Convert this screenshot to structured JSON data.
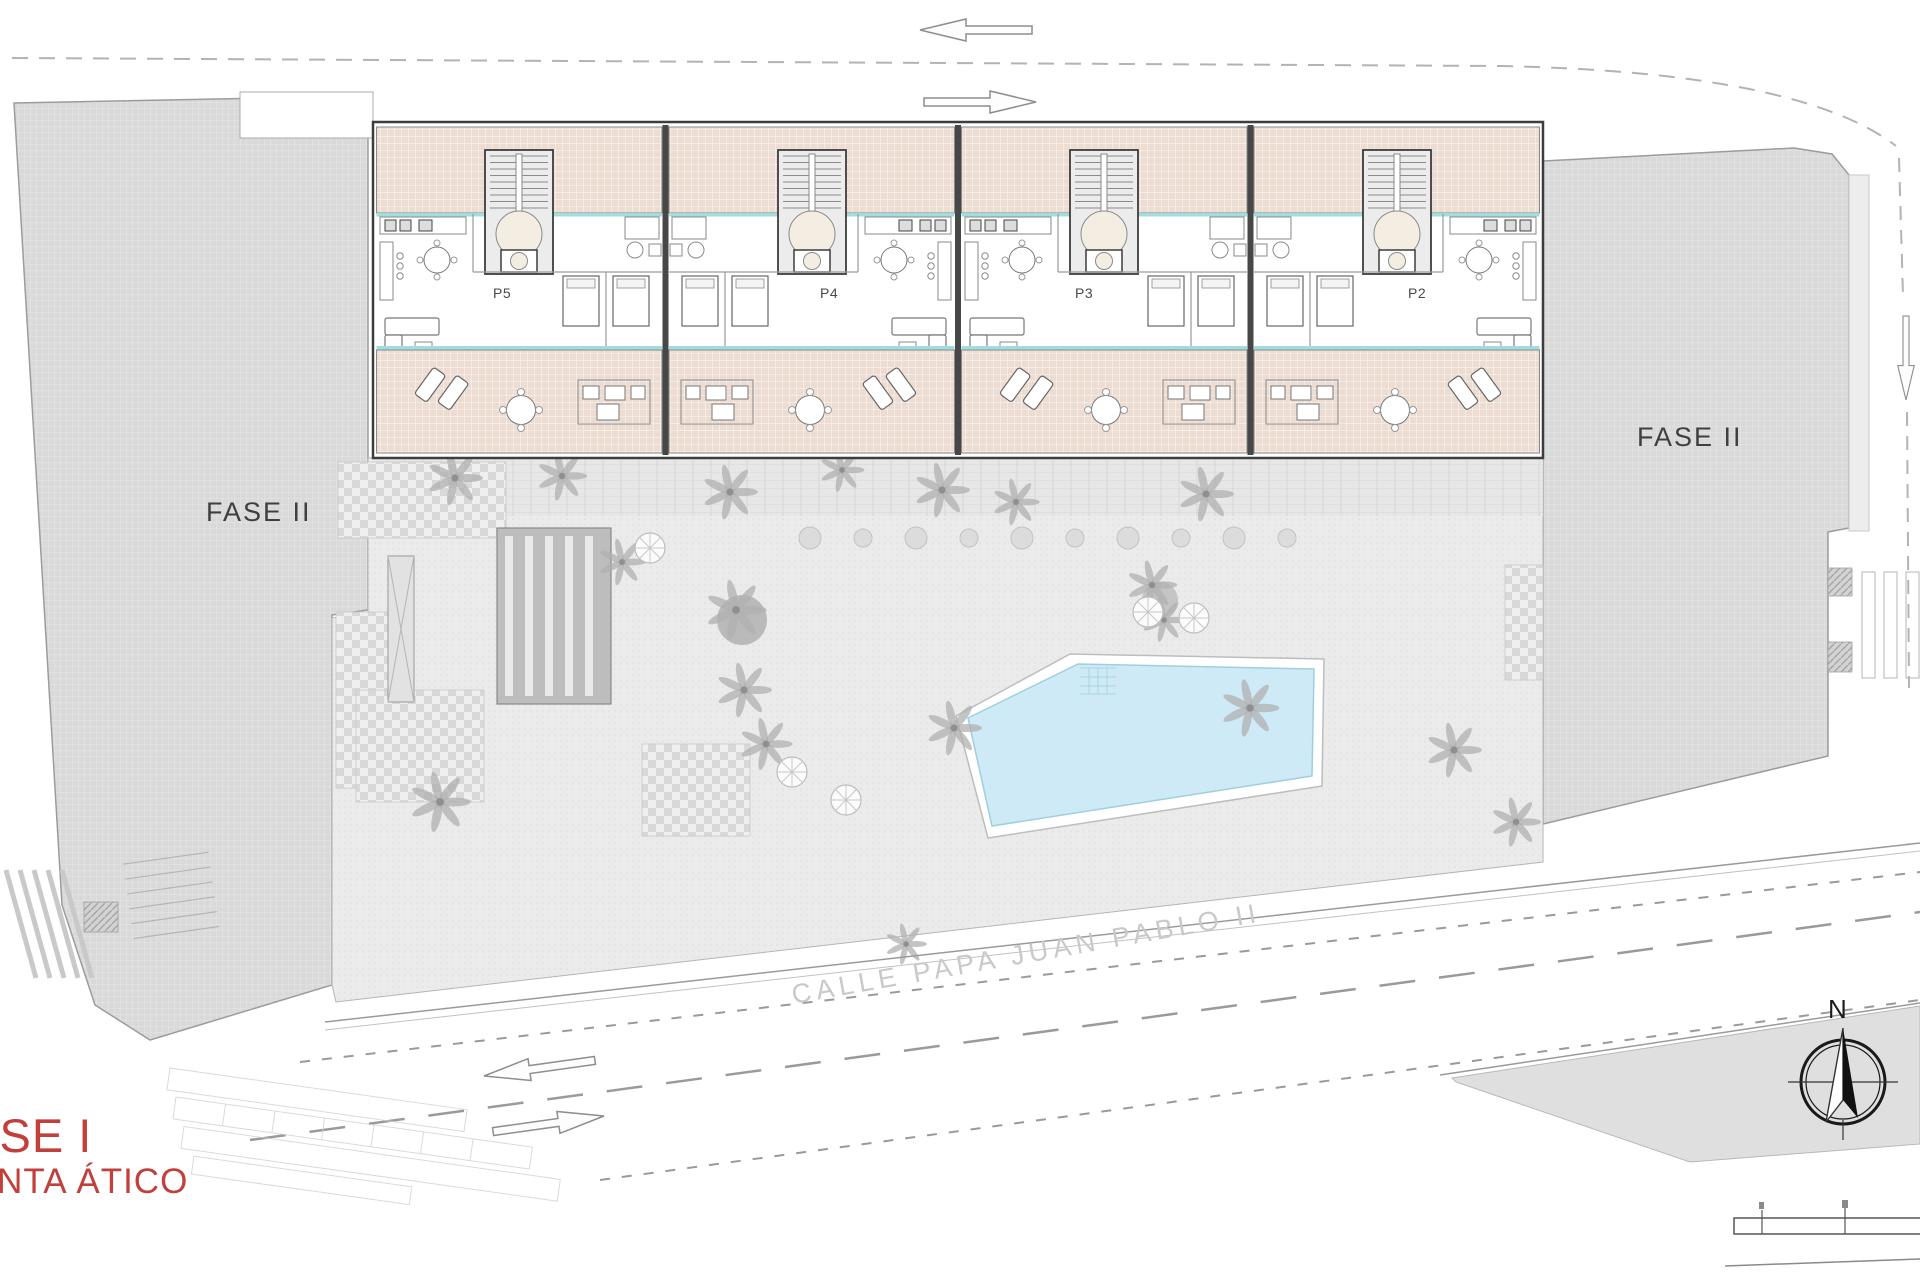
{
  "titles": {
    "phase": "FASE I",
    "plan": "PLANTA ÁTICO"
  },
  "labels": {
    "fase2_left": "FASE II",
    "fase2_right": "FASE II"
  },
  "street": {
    "name": "CALLE PAPA JUAN PABLO II"
  },
  "units": [
    {
      "label": "P5"
    },
    {
      "label": "P4"
    },
    {
      "label": "P3"
    },
    {
      "label": "P2"
    }
  ],
  "compass": {
    "north": "N"
  },
  "colors": {
    "terrace_tile": "#eddcd2",
    "pool_water": "#cdeaf6",
    "phase2_block": "#d9d9d9",
    "window_sill_teal": "#9fdde0",
    "wall": "#3d3d3d",
    "title_red": "#c2403c",
    "street_dash": "#9a9a9a"
  }
}
